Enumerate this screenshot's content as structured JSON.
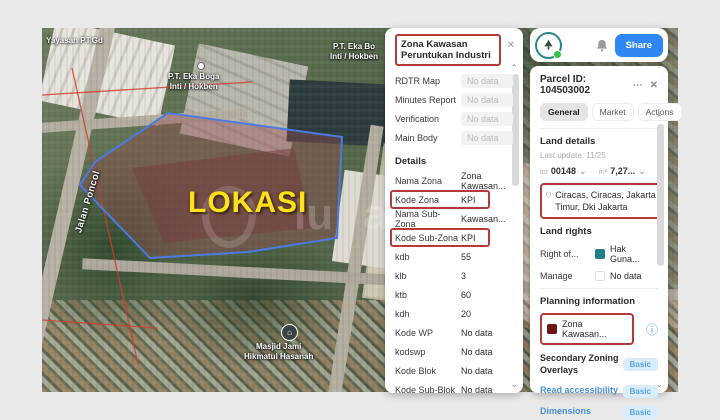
{
  "map": {
    "lokasi": "LOKASI",
    "watermark": "lu a",
    "street": "Jalan Poncol",
    "label_yayasan": "Yayasan PT.Gd",
    "label_hokben_1a": "P.T. Eka Boga",
    "label_hokben_1b": "Inti / Hokben",
    "label_hokben_2a": "P.T. Eka Bo",
    "label_hokben_2b": "Inti / Hokben",
    "label_mosque_a": "Masjid Jami",
    "label_mosque_b": "Hikmatul Hasanah",
    "mosque_glyph": "⌂",
    "colors": {
      "lokasi_yellow": "#ffe01a",
      "parcel_stroke": "#4b7be0",
      "parcel_fill": "rgba(150,75,80,0.40)",
      "boundary_red": "#d23b2f"
    }
  },
  "mid_panel": {
    "title": "Zona Kawasan Peruntukan Industri",
    "close_icon": "✕",
    "scroll_up_icon": "⌃",
    "scroll_down_icon": "⌄",
    "rows_top": [
      {
        "label": "RDTR Map",
        "value": "No data"
      },
      {
        "label": "Minutes Report",
        "value": "No data"
      },
      {
        "label": "Verification",
        "value": "No data"
      },
      {
        "label": "Main Body",
        "value": "No data"
      }
    ],
    "details_header": "Details",
    "rows_details": [
      {
        "label": "Nama Zona",
        "value": "Zona Kawasan..."
      },
      {
        "label": "Kode Zona",
        "value": "KPI"
      },
      {
        "label": "Nama Sub-Zona",
        "value": "Kawasan..."
      },
      {
        "label": "Kode Sub-Zona",
        "value": "KPI"
      },
      {
        "label": "kdb",
        "value": "55"
      },
      {
        "label": "klb",
        "value": "3"
      },
      {
        "label": "ktb",
        "value": "60"
      },
      {
        "label": "kdh",
        "value": "20"
      },
      {
        "label": "Kode WP",
        "value": "No data"
      },
      {
        "label": "kodswp",
        "value": "No data"
      },
      {
        "label": "Kode Blok",
        "value": "No data"
      },
      {
        "label": "Kode Sub-Blok",
        "value": "No data"
      }
    ],
    "highlight_color": "#b43b3b"
  },
  "toolbar": {
    "share_label": "Share",
    "share_color": "#2f87f4"
  },
  "right_panel": {
    "title": "Parcel ID: 104503002",
    "menu_icon": "⋯",
    "close_icon": "✕",
    "scroll_up_icon": "⌃",
    "scroll_down_icon": "⌄",
    "chevron_icon": "⌄",
    "info_icon": "ⓘ",
    "tabs": [
      {
        "label": "General"
      },
      {
        "label": "Market"
      },
      {
        "label": "Actions"
      }
    ],
    "land_details_header": "Land details",
    "last_update": "Last update: 11/25",
    "lot_prefix": "lot",
    "lot_value": "00148",
    "area_prefix": "m²",
    "area_value": "7,27...",
    "address": "Ciracas, Ciracas, Jakarta Timur, Dki Jakarta",
    "land_rights_header": "Land rights",
    "right_of_label": "Right of...",
    "right_of_value": "Hak Guna...",
    "manage_label": "Manage",
    "manage_value": "No data",
    "planning_header": "Planning information",
    "zona_value": "Zona Kawasan...",
    "basic_rows": [
      {
        "label": "Secondary Zoning Overlays",
        "badge": "Basic"
      },
      {
        "label": "Read accessibility",
        "badge": "Basic"
      },
      {
        "label": "Dimensions",
        "badge": "Basic"
      }
    ],
    "colors": {
      "badge_bg": "#d9ecfc",
      "badge_text": "#55a6e0",
      "link_blue": "#4a90d9",
      "teal_swatch": "#1f7f8a",
      "darkred_swatch": "#6e1414",
      "highlight_red": "#b43b3b"
    }
  }
}
